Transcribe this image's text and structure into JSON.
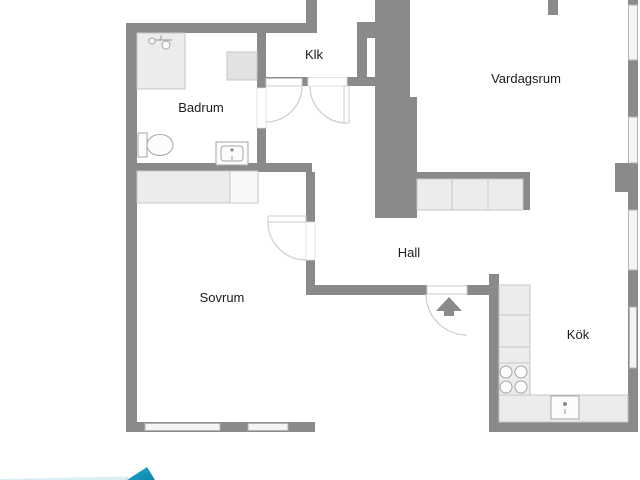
{
  "plan": {
    "title": "apartment-floor-plan",
    "rooms": [
      {
        "id": "badrum",
        "label": "Badrum"
      },
      {
        "id": "klk",
        "label": "Klk"
      },
      {
        "id": "vardagsrum",
        "label": "Vardagsrum"
      },
      {
        "id": "hall",
        "label": "Hall"
      },
      {
        "id": "sovrum",
        "label": "Sovrum"
      },
      {
        "id": "kok",
        "label": "Kök"
      }
    ],
    "fixtures": [
      "shower",
      "bathroom-cabinet",
      "toilet",
      "bathroom-sink",
      "bedroom-wardrobe",
      "hallway-wardrobe",
      "entrance-door-arrow",
      "kitchen-counter",
      "stove-burners",
      "kitchen-sink",
      "windows"
    ]
  },
  "colors": {
    "background": "#ffffff",
    "wall": "#8a8a8a",
    "window_fill": "#f4f4f4",
    "window_stroke": "#b4b4b4",
    "furniture_fill": "#ececec",
    "furniture_stroke": "#c6c6c6",
    "fixture_fill": "#fcfcfc",
    "fixture_stroke": "#a6a6a6",
    "door_stroke": "#cbcbcb",
    "label": "#1c1c1c",
    "logo_teal": "#1599bd",
    "logo_teal_light": "#8ed4e6",
    "logo_strip": "#d9eef5"
  },
  "branding": {
    "logo": "realtor-logo-triangle-bottom-left"
  }
}
